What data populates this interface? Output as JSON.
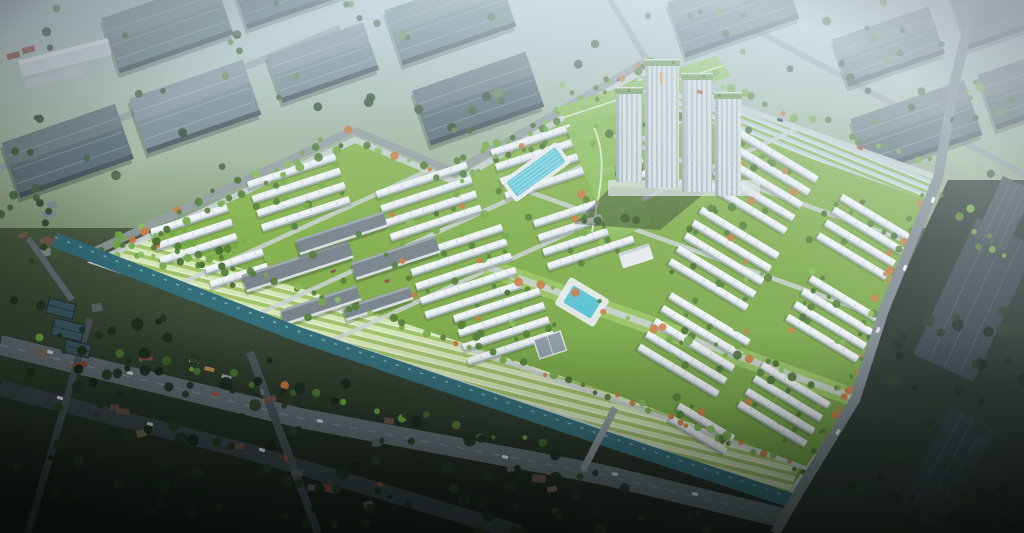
{
  "scene": {
    "label": "Aerial 3D master-plan render: residential estate with townhouse rows, high-rise apartment cluster, canal and striped gardens, surrounded by an industrial warehouse park and a darker existing town",
    "seed": 1337,
    "regions": [
      "industrial-district",
      "residential-estate",
      "high-rise-towers",
      "linear-park",
      "striped-gardens",
      "canal",
      "boulevard",
      "old-town",
      "dark-warehouse-zone"
    ]
  },
  "palette": {
    "sky_top": "#b7c7cf",
    "ground_mid": "#647c54",
    "ground_dark": "#1b251f",
    "forest": "#3f5c38",
    "forest_light": "#5d8048",
    "estate_green": "#7cae45",
    "estate_green_deep": "#6f9f3d",
    "lawn_light": "#97c45c",
    "house_roof": "#f2f6f7",
    "house_roof_shade": "#c6d1d6",
    "house_edge": "#93a1a9",
    "warehouse_roof": "#64767f",
    "warehouse_roof_alt": "#556670",
    "warehouse_dark": "#38444b",
    "road": "#8f999e",
    "road_light": "#c9d1d4",
    "road_dark": "#525d63",
    "canal": "#2f6a76",
    "canal_light": "#7fc0cb",
    "pool": "#5bc4d6",
    "tree_green": "#4c7a2f",
    "tree_green_light": "#6fa63f",
    "tree_orange": "#c8763d",
    "tower_wall": "#d7dfe3",
    "tower_shade": "#a9b7bf",
    "tower_roof_green": "#66934a",
    "tower_accent": "#d89b3a",
    "stripe_light": "#d8e8b8",
    "stripe_pale": "#eef4e2",
    "stripe_green": "#a0c266",
    "parking_blue": "#bad4de",
    "old_town": "#24301f",
    "dark_zone": "#1f2a24",
    "shadow": "#14201a"
  }
}
